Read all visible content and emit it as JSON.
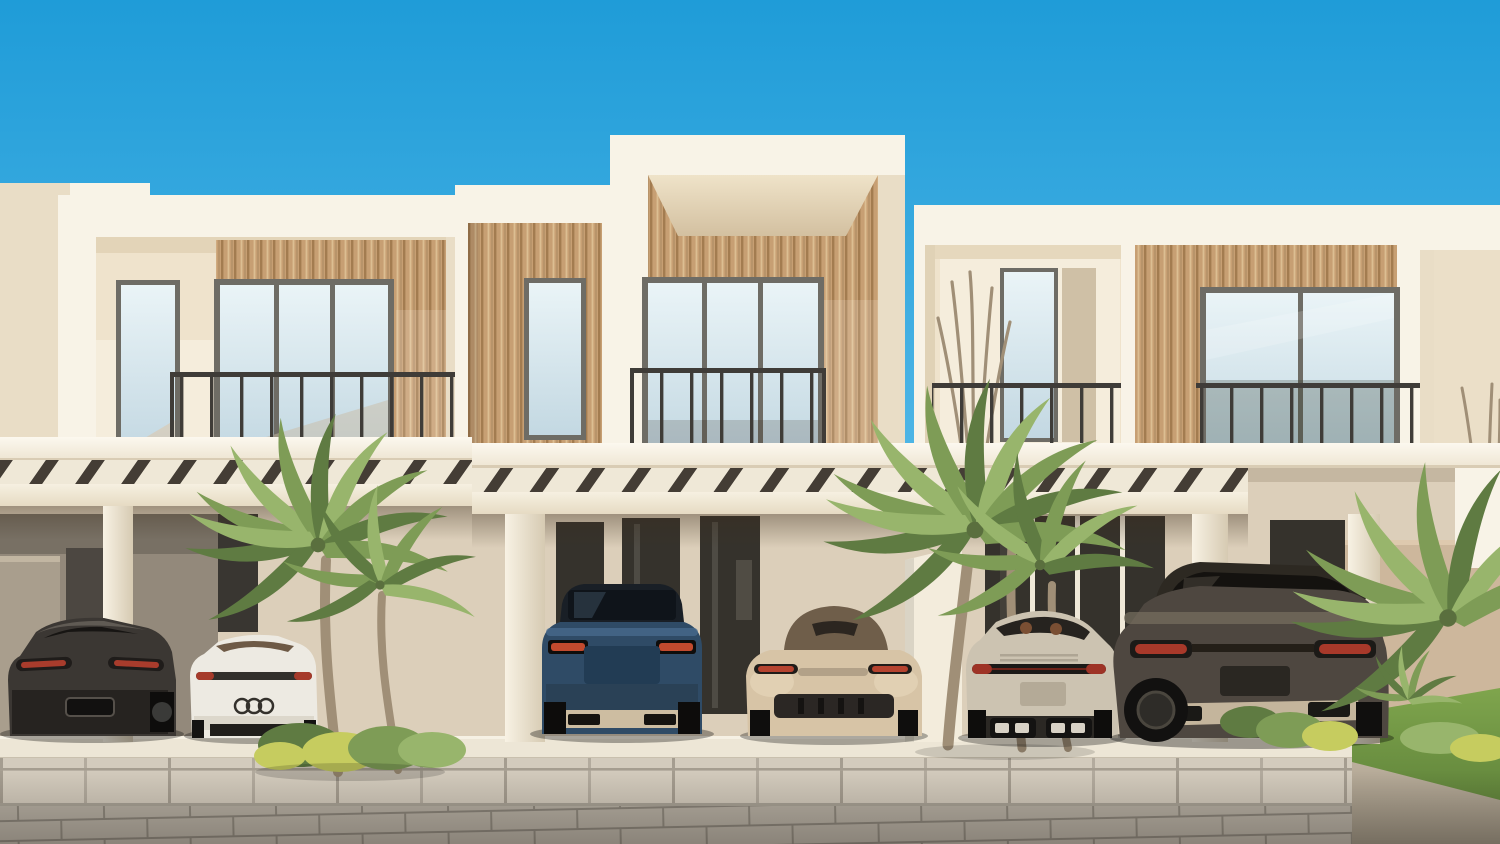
{
  "scene": {
    "description": "Photorealistic daytime rendering of a modern two-storey townhouse row with cream frames and wood-slat facades; six luxury cars are parked in shaded carports under a slatted pergola, with palm trees, green lawn and a stone-paver driveway beneath a clear blue sky",
    "setting": "residential street, sunny day, clear sky",
    "buildings_count": 3,
    "vehicles_count": 6
  },
  "colors": {
    "sky_top": "#1F9CD8",
    "sky_mid": "#4FB6E6",
    "sky_low": "#90D3F0",
    "frame_cream": "#F8F3E7",
    "frame_shadow": "#E9DDC6",
    "wall_beige": "#EFE3CC",
    "wall_light": "#F5EDDC",
    "wood_base": "#C79F73",
    "wood_dark": "#A37C50",
    "wood_light": "#DCBE92",
    "window_frame": "#6E6C65",
    "glass_top": "#EAF4F7",
    "glass_bottom": "#C3D8E2",
    "railing": "#3F3C38",
    "ground_wall": "#DCCFBA",
    "dark_glass": "#35322C",
    "garage_taupe": "#93897B",
    "low_wall": "#A99E8D",
    "partition": "#F3ECDC",
    "tan_wall": "#CDB79C",
    "pergola_slat": "#3A352F",
    "platform": "#EDE6D6",
    "sidewalk": "#D3CBBD",
    "road": "#B6AFA3",
    "grass": "#7FA54D",
    "grass_dark": "#61853B",
    "bush_yellow": "#C6CC5F",
    "palm_green": "#7E9C56",
    "palm_dark": "#5F7B42",
    "palm_light": "#98B56C",
    "trunk": "#A08F77",
    "taillight_red": "#A83C2C",
    "skid_plate": "#CDBDA1"
  },
  "buildings": {
    "left_parapet": {
      "name": "neighbouring parapet wall"
    },
    "left": {
      "name": "left townhouse",
      "features": [
        "cream box frame",
        "wood slat accent panel",
        "narrow window",
        "three-pane picture window",
        "metal balcony railing",
        "carport pergola"
      ]
    },
    "connector": {
      "name": "connecting bay",
      "features": [
        "wood slat facade",
        "narrow window"
      ]
    },
    "center": {
      "name": "center townhouse (tallest)",
      "features": [
        "cream box frame",
        "full wood slat facade",
        "three-pane picture window",
        "metal balcony railing"
      ]
    },
    "right": {
      "name": "right townhouse",
      "features": [
        "recessed balcony with tall plant",
        "narrow window and door",
        "wood slat panel",
        "two-pane picture window",
        "metal balcony railings"
      ]
    }
  },
  "vehicles": [
    {
      "name": "charcoal-coupe",
      "type": "fastback sports coupe",
      "view": "rear",
      "color": "#3B3733"
    },
    {
      "name": "white-sports-car",
      "type": "sports car with three-ring badge",
      "view": "rear",
      "color": "#EDEAE2"
    },
    {
      "name": "blue-suv",
      "type": "luxury SUV with champagne skid plate",
      "view": "rear",
      "color": "#2F4B66"
    },
    {
      "name": "beige-convertible",
      "type": "roadster with brown soft top",
      "view": "rear",
      "color": "#D7C4A6"
    },
    {
      "name": "champagne-911",
      "type": "sports car with quad exhaust",
      "view": "rear",
      "color": "#CCC3B1"
    },
    {
      "name": "bronze-suv",
      "type": "large luxury SUV",
      "view": "rear-quarter",
      "color": "#4E4740"
    }
  ],
  "vegetation": {
    "palms": [
      "twin palm left of carports",
      "large palm cluster center-right",
      "palm fronds far right",
      "small fan palm on lawn"
    ],
    "other": [
      "yellow-green shrubs left",
      "shrub bed right",
      "spiky balcony plant",
      "lawn on the right"
    ]
  },
  "ground": {
    "surfaces": [
      "carport platform slab",
      "large tile sidewalk",
      "stone paver road",
      "smooth driveway apron",
      "lawn"
    ]
  }
}
